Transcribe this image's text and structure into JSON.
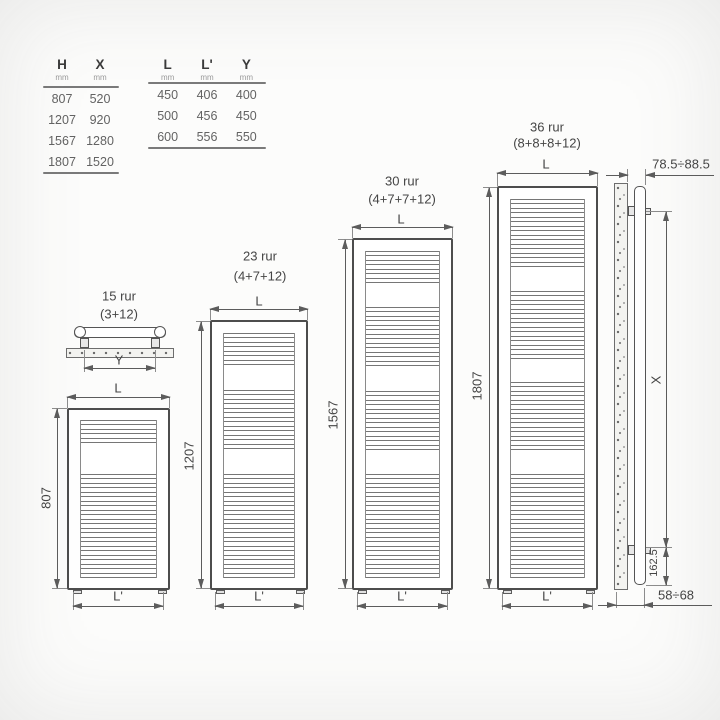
{
  "tables": {
    "hx": {
      "columns": [
        {
          "label": "H",
          "unit": "mm"
        },
        {
          "label": "X",
          "unit": "mm"
        }
      ],
      "rows": [
        [
          "807",
          "520"
        ],
        [
          "1207",
          "920"
        ],
        [
          "1567",
          "1280"
        ],
        [
          "1807",
          "1520"
        ]
      ]
    },
    "lly": {
      "columns": [
        {
          "label": "L",
          "unit": "mm"
        },
        {
          "label": "L'",
          "unit": "mm"
        },
        {
          "label": "Y",
          "unit": "mm"
        }
      ],
      "rows": [
        [
          "450",
          "406",
          "400"
        ],
        [
          "500",
          "456",
          "450"
        ],
        [
          "600",
          "556",
          "550"
        ]
      ]
    }
  },
  "top_view": {
    "width_label": "Y"
  },
  "radiators": [
    {
      "title": "15 rur",
      "formula": "(3+12)",
      "height": "807",
      "top_width": "L",
      "bottom_width": "L'",
      "groups": [
        3,
        12
      ]
    },
    {
      "title": "23 rur",
      "formula": "(4+7+12)",
      "height": "1207",
      "top_width": "L",
      "bottom_width": "L'",
      "groups": [
        4,
        7,
        12
      ]
    },
    {
      "title": "30 rur",
      "formula": "(4+7+7+12)",
      "height": "1567",
      "top_width": "L",
      "bottom_width": "L'",
      "groups": [
        4,
        7,
        7,
        12
      ]
    },
    {
      "title": "36 rur",
      "formula": "(8+8+8+12)",
      "height": "1807",
      "top_width": "L",
      "bottom_width": "L'",
      "groups": [
        8,
        8,
        8,
        12
      ]
    }
  ],
  "side_view": {
    "wall_offset": "78.5÷88.5",
    "height_label": "X",
    "bottom_spacing": "162.5",
    "depth": "58÷68"
  }
}
